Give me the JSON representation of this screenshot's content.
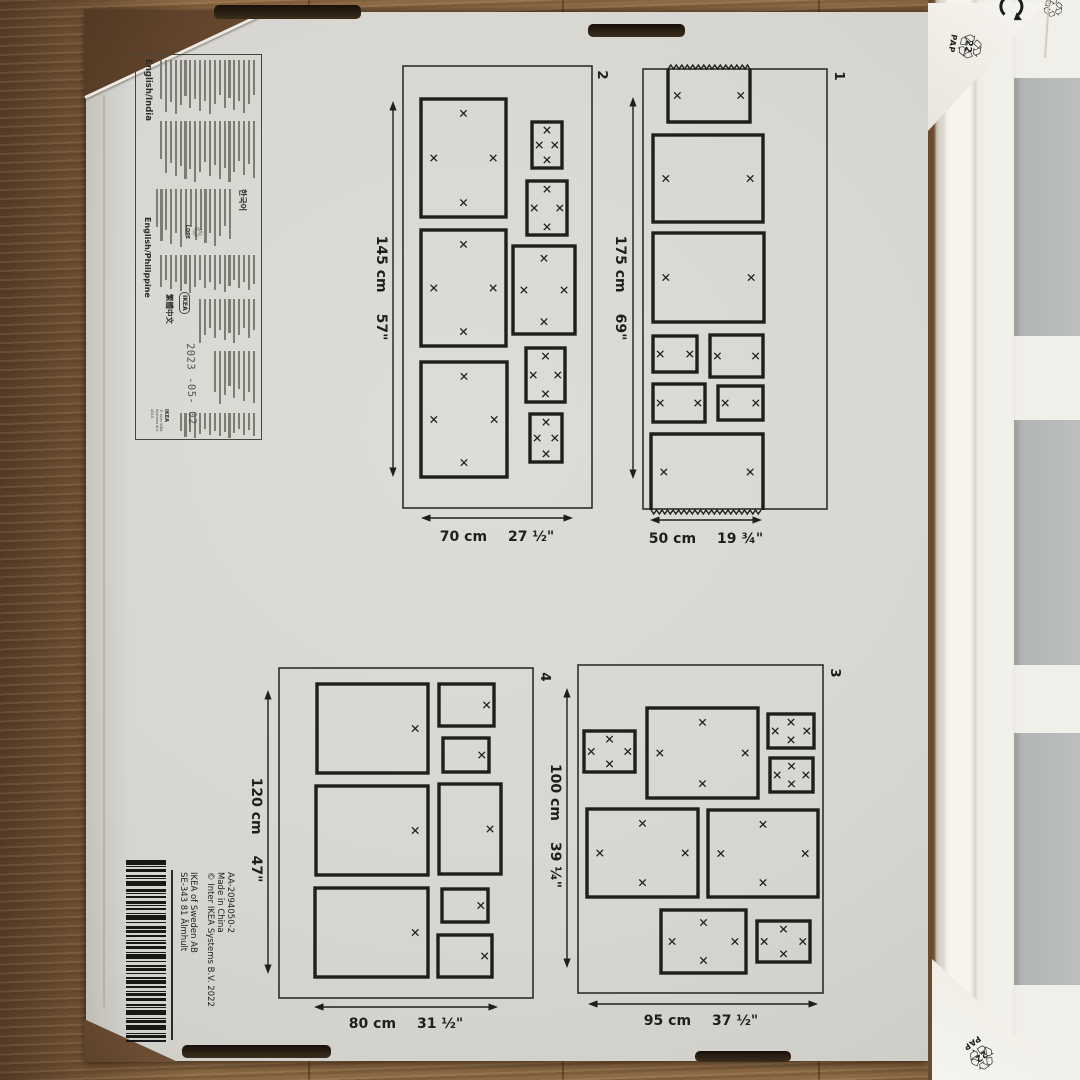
{
  "colors": {
    "line": "#1e1e1c",
    "outer_line": "#2e2e2c",
    "box_face": "#d7d6d1",
    "wood_mid": "#8c6a46",
    "wood_dark": "#5a402a",
    "slot_dark": "#241c12",
    "frame_white": "#f4f2ed",
    "mat_white": "#f1efe9",
    "opening_gray": "#b7bab8",
    "triangle_white": "#f3f1ec"
  },
  "info_label": {
    "language_editions": [
      "English/India",
      "한국어",
      "English/Philippine",
      "繁體中文"
    ],
    "recycle_material": "LDPE",
    "brand": "IKEA",
    "date_stamp": "2023 -05- 02",
    "copyright": "© Inter IKEA Systems B.V. 2015"
  },
  "barcode_label": {
    "article": "AA-2094050-2",
    "origin": "Made in China",
    "copyright": "© Inter IKEA Systems B.V. 2022",
    "company": "IKEA of Sweden AB",
    "address": "SE-343 81 Älmhult"
  },
  "recycling_mark": {
    "code": "22",
    "material": "PAP"
  },
  "diagrams": [
    {
      "label": "1",
      "outer": [
        643,
        69,
        184,
        440
      ],
      "label_pos": [
        835,
        76
      ],
      "height_cm": "175 cm",
      "height_in": "69\"",
      "width_cm": "50 cm",
      "width_in": "19 ¾\"",
      "vdim": {
        "x": 633,
        "y1": 97,
        "y2": 479,
        "tx": 616,
        "ty": 288
      },
      "hdim": {
        "y": 520,
        "x1": 650,
        "x2": 762,
        "tx": 706,
        "ty": 534
      },
      "frames": [
        {
          "r": [
            668,
            69,
            82,
            53
          ],
          "m": "lr",
          "jag": "top"
        },
        {
          "r": [
            653,
            135,
            110,
            87
          ],
          "m": "lr"
        },
        {
          "r": [
            653,
            233,
            111,
            89
          ],
          "m": "lr"
        },
        {
          "r": [
            653,
            336,
            44,
            36
          ],
          "m": "lr"
        },
        {
          "r": [
            710,
            335,
            53,
            42
          ],
          "m": "lr"
        },
        {
          "r": [
            653,
            384,
            52,
            38
          ],
          "m": "lr"
        },
        {
          "r": [
            718,
            386,
            45,
            34
          ],
          "m": "lr"
        },
        {
          "r": [
            651,
            434,
            112,
            76
          ],
          "m": "lr",
          "jag": "bottom"
        }
      ]
    },
    {
      "label": "2",
      "outer": [
        403,
        66,
        189,
        442
      ],
      "label_pos": [
        598,
        75
      ],
      "height_cm": "145 cm",
      "height_in": "57\"",
      "width_cm": "70 cm",
      "width_in": "27 ½\"",
      "vdim": {
        "x": 393,
        "y1": 101,
        "y2": 477,
        "tx": 377,
        "ty": 288
      },
      "hdim": {
        "y": 518,
        "x1": 421,
        "x2": 573,
        "tx": 497,
        "ty": 532
      },
      "frames": [
        {
          "r": [
            421,
            99,
            85,
            118
          ],
          "m": "tlrb"
        },
        {
          "r": [
            421,
            230,
            85,
            116
          ],
          "m": "tlrb"
        },
        {
          "r": [
            421,
            362,
            86,
            115
          ],
          "m": "tlrb"
        },
        {
          "r": [
            532,
            122,
            30,
            46
          ],
          "m": "tlrb"
        },
        {
          "r": [
            527,
            181,
            40,
            54
          ],
          "m": "tlrb"
        },
        {
          "r": [
            513,
            246,
            62,
            88
          ],
          "m": "tlrb"
        },
        {
          "r": [
            526,
            348,
            39,
            54
          ],
          "m": "tlrb"
        },
        {
          "r": [
            530,
            414,
            32,
            48
          ],
          "m": "tlrb"
        }
      ]
    },
    {
      "label": "3",
      "outer": [
        578,
        665,
        245,
        328
      ],
      "label_pos": [
        831,
        673
      ],
      "height_cm": "100 cm",
      "height_in": "39 ¼\"",
      "width_cm": "95 cm",
      "width_in": "37 ½\"",
      "vdim": {
        "x": 567,
        "y1": 688,
        "y2": 968,
        "tx": 551,
        "ty": 826
      },
      "hdim": {
        "y": 1004,
        "x1": 588,
        "x2": 818,
        "tx": 701,
        "ty": 1016
      },
      "frames": [
        {
          "r": [
            584,
            731,
            51,
            41
          ],
          "m": "tlrb"
        },
        {
          "r": [
            647,
            708,
            111,
            90
          ],
          "m": "tlrb"
        },
        {
          "r": [
            768,
            714,
            46,
            34
          ],
          "m": "tlrb"
        },
        {
          "r": [
            770,
            758,
            43,
            34
          ],
          "m": "tlrb"
        },
        {
          "r": [
            587,
            809,
            111,
            88
          ],
          "m": "tlrb"
        },
        {
          "r": [
            708,
            810,
            110,
            87
          ],
          "m": "tlrb"
        },
        {
          "r": [
            661,
            910,
            85,
            63
          ],
          "m": "tlrb"
        },
        {
          "r": [
            757,
            921,
            53,
            41
          ],
          "m": "tlrb"
        }
      ]
    },
    {
      "label": "4",
      "outer": [
        279,
        668,
        254,
        330
      ],
      "label_pos": [
        541,
        677
      ],
      "height_cm": "120 cm",
      "height_in": "47\"",
      "width_cm": "80 cm",
      "width_in": "31 ½\"",
      "vdim": {
        "x": 268,
        "y1": 690,
        "y2": 974,
        "tx": 252,
        "ty": 830
      },
      "hdim": {
        "y": 1007,
        "x1": 314,
        "x2": 498,
        "tx": 406,
        "ty": 1019
      },
      "frames": [
        {
          "r": [
            317,
            684,
            111,
            89
          ],
          "m": "r"
        },
        {
          "r": [
            439,
            684,
            55,
            42
          ],
          "m": "r"
        },
        {
          "r": [
            443,
            738,
            46,
            34
          ],
          "m": "r"
        },
        {
          "r": [
            316,
            786,
            112,
            89
          ],
          "m": "r"
        },
        {
          "r": [
            439,
            784,
            62,
            90
          ],
          "m": "r"
        },
        {
          "r": [
            315,
            888,
            113,
            89
          ],
          "m": "r"
        },
        {
          "r": [
            442,
            889,
            46,
            33
          ],
          "m": "r"
        },
        {
          "r": [
            438,
            935,
            54,
            42
          ],
          "m": "r"
        }
      ]
    }
  ]
}
